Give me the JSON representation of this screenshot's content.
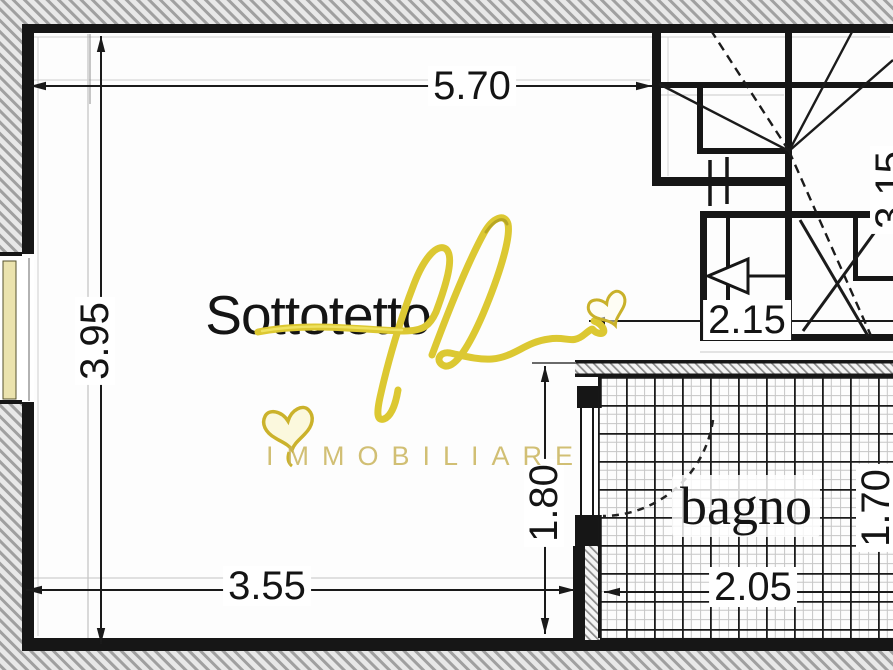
{
  "title": "Planimetria sottotetto",
  "rooms": {
    "main_label": "Sottotetto",
    "bath_label": "bagno"
  },
  "dimensions": {
    "top_width": "5.70",
    "left_height": "3.95",
    "stair_width": "2.15",
    "bath_inner_height": "1.80",
    "bottom_width": "3.55",
    "bath_width": "2.05",
    "bath_right_height": "1.70",
    "right_upper_height": "3.15"
  },
  "watermark": {
    "script_monogram": "fb",
    "brand": "IMMOBILIARE",
    "icons": [
      "heart-icon",
      "heart-icon"
    ]
  },
  "colors": {
    "line": "#1a1a1a",
    "exterior_hatch": "#9e9e9e",
    "wall_hatch": "#8a8a8a",
    "window_glass": "#ebe3ae",
    "watermark_yellow": "#dcc832",
    "brand_gold": "#c8b257"
  }
}
